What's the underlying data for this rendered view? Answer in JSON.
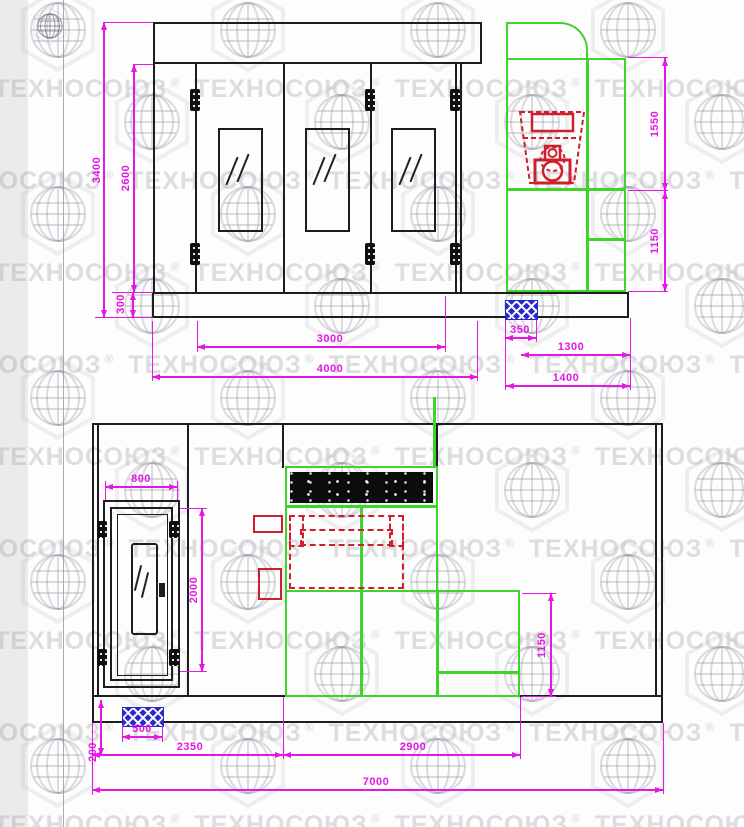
{
  "watermark": {
    "text": "ТЕХНОСОЮЗ",
    "registered_mark": "®",
    "globe_icon": "globe-grid-icon"
  },
  "palette": {
    "dimension_magenta": "#e318e3",
    "line_black": "#1d1d1f",
    "unit_green": "#3fd32b",
    "burner_red": "#cf1f2e",
    "fan_blue": "#2828cc",
    "watermark_gray": "#9494a0",
    "margin_strip_gray": "#ebebeb"
  },
  "views": {
    "front_view": {
      "name": "front-view",
      "dimensions": {
        "total_height": "3400",
        "opening_height": "2600",
        "base_height": "300",
        "doors_width": "3000",
        "booth_width": "4000",
        "exhaust_fan_width": "350",
        "cabinet_width": "1300",
        "cabinet_overall_width": "1400",
        "cabinet_upper_height": "1550",
        "cabinet_lower_height": "1150"
      }
    },
    "side_view": {
      "name": "side-view",
      "dimensions": {
        "door_width": "800",
        "door_height": "2000",
        "exhaust_fan_width": "500",
        "base_height": "200",
        "front_section_length": "2350",
        "machine_section_length": "2900",
        "cabinet_lower_height": "1150",
        "total_length": "7000"
      }
    }
  }
}
